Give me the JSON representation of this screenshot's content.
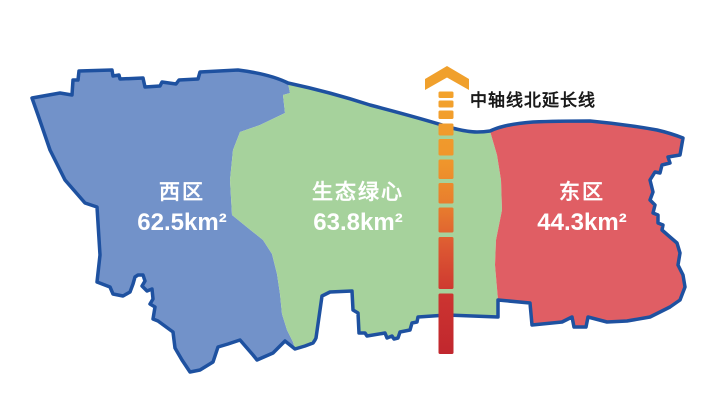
{
  "map": {
    "background": "#FFFFFF",
    "border_color": "#1E51A0",
    "regions": [
      {
        "name": "西区",
        "area": "62.5km²",
        "fill": "#7292C9"
      },
      {
        "name": "生态绿心",
        "area": "63.8km²",
        "fill": "#A6D29C"
      },
      {
        "name": "东区",
        "area": "44.3km²",
        "fill": "#E05E64"
      }
    ],
    "axis_line": {
      "label": "中轴线北延长线",
      "label_color": "#1A1A1A",
      "arrow_color": "#F0A02C",
      "gradient_top": "#F3A32C",
      "gradient_bottom": "#C1272E"
    }
  }
}
